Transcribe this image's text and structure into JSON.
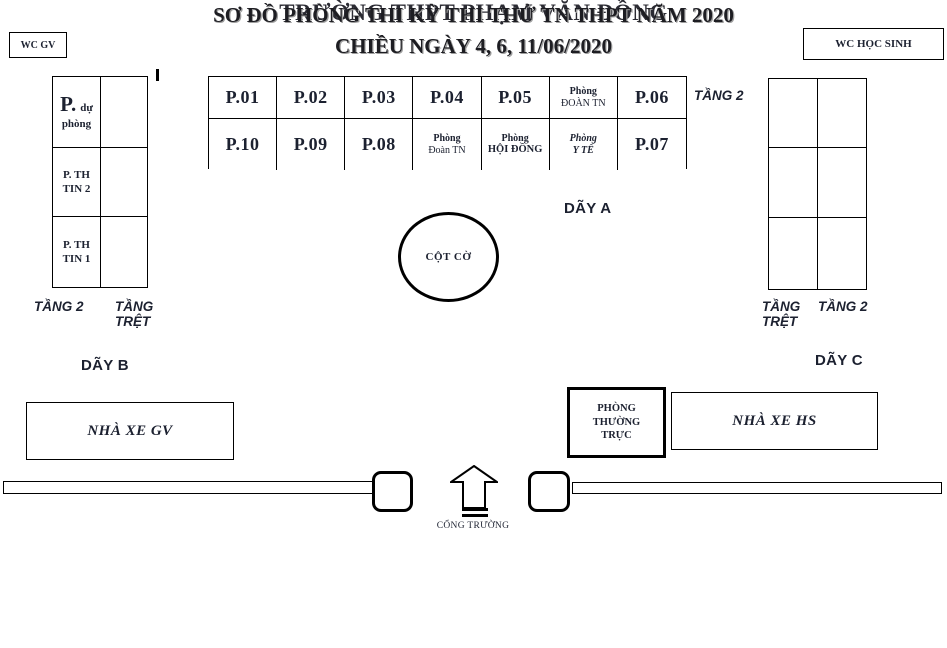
{
  "colors": {
    "ink": "#1c2130",
    "line": "#000000",
    "title": "#2b2b33",
    "footer_shadow": "#9e9e9e"
  },
  "header": {
    "title": "TRƯỜNG THPT PHẠM VĂN ĐỒNG"
  },
  "wc": {
    "gv": "WC GV",
    "hs": "WC HỌC SINH"
  },
  "building_b": {
    "name": "DÃY B",
    "rooms": [
      {
        "big": "P.",
        "small": "dự",
        "line2": "phòng"
      },
      {
        "line1": "P. TH",
        "line2": "TIN 2"
      },
      {
        "line1": "P. TH",
        "line2": "TIN 1"
      }
    ],
    "floor_left": "TẦNG 2",
    "floor_right": "TẦNG\nTRỆT"
  },
  "day_a": {
    "name": "DÃY A",
    "floor": "TẦNG 2",
    "row1": [
      {
        "label": "P.01"
      },
      {
        "label": "P.02"
      },
      {
        "label": "P.03"
      },
      {
        "label": "P.04"
      },
      {
        "label": "P.05"
      },
      {
        "line1": "Phòng",
        "line2": "ĐOÀN TN"
      },
      {
        "label": "P.06"
      }
    ],
    "row2": [
      {
        "label": "P.10"
      },
      {
        "label": "P.09"
      },
      {
        "label": "P.08"
      },
      {
        "line1": "Phòng",
        "line2": "Đoàn TN"
      },
      {
        "line1": "Phòng",
        "line2": "HỘI ĐỒNG"
      },
      {
        "line1": "Phòng",
        "line2": "Y TẾ"
      },
      {
        "label": "P.07"
      }
    ]
  },
  "flag": {
    "label": "CỘT CỜ"
  },
  "building_c": {
    "name": "DÃY C",
    "floor_left": "TẦNG\nTRỆT",
    "floor_right": "TẦNG 2"
  },
  "parking_gv": {
    "label": "NHÀ  XE GV"
  },
  "guard_room": {
    "label": "PHÒNG\nTHƯỜNG\nTRỰC"
  },
  "parking_hs": {
    "label": "NHÀ  XE HS"
  },
  "gate": {
    "label": "CỔNG TRƯỜNG"
  },
  "footer": {
    "line1": "SƠ ĐỒ PHÒNG THI KỲ THI THỬ TN THPT NĂM 2020",
    "line2": "CHIỀU NGÀY 4, 6, 11/06/2020"
  }
}
